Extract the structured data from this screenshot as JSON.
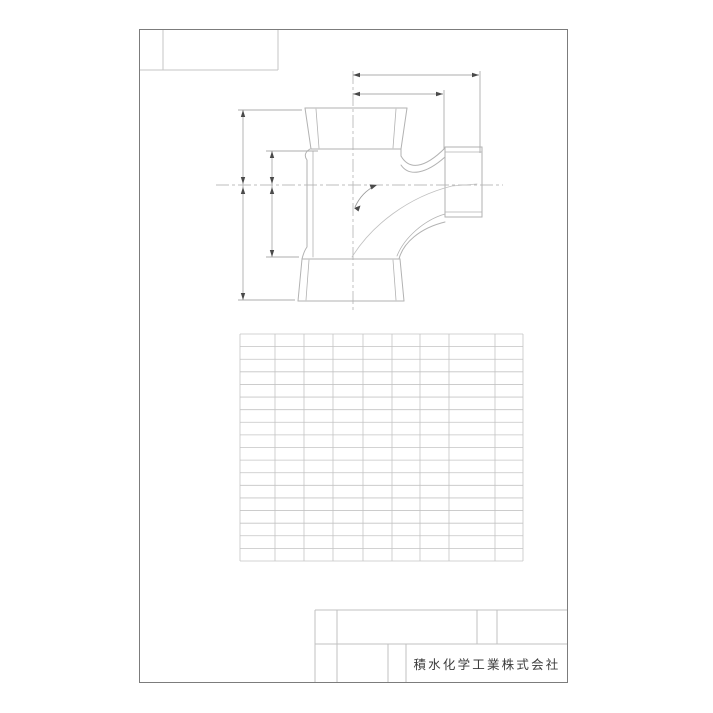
{
  "sheet": {
    "background": "#ffffff",
    "frame_color": "#7c7c7c",
    "outline_color": "#b2b2b2",
    "grid_line_color": "#c4c4c4",
    "text_color": "#3c3c3c",
    "subject": "sanitary-tee-pipe-fitting-front-view"
  },
  "title_block": {
    "company": "積水化学工業株式会社"
  },
  "grid": {
    "col_edges": [
      240,
      275,
      304,
      333,
      363,
      392,
      420,
      449,
      495,
      523
    ],
    "rows": 18,
    "top": 334,
    "bottom": 561
  }
}
